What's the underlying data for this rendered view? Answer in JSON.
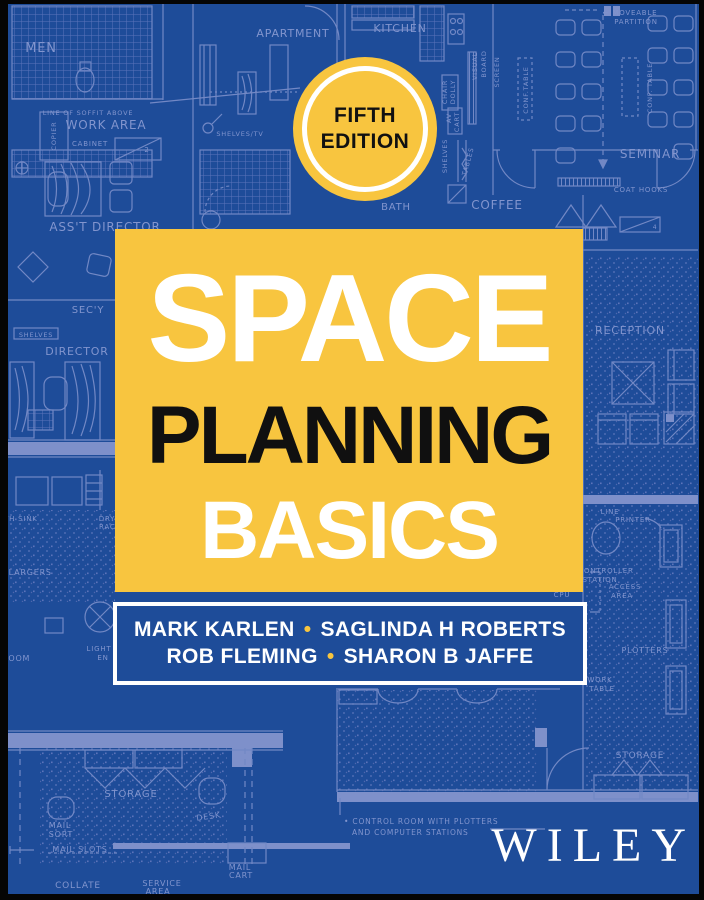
{
  "cover": {
    "edition_badge": {
      "line1": "FIFTH",
      "line2": "EDITION"
    },
    "title": {
      "line1": "SPACE",
      "line2": "PLANNING",
      "line3": "BASICS"
    },
    "authors": {
      "line1_a": "MARK KARLEN",
      "line1_b": "SAGLINDA H ROBERTS",
      "line2_a": "ROB FLEMING",
      "line2_b": "SHARON B JAFFE",
      "separator": "•"
    },
    "publisher": "WILEY",
    "colors": {
      "cover_blue": "#1E4C99",
      "accent_yellow": "#F8C53F",
      "blueprint_line": "#7288C5",
      "blueprint_wall": "#7E90CA",
      "title_white": "#FFFFFF",
      "title_black": "#101010",
      "frame_black": "#050505"
    }
  },
  "blueprint": {
    "labels": [
      {
        "text": "MEN",
        "x": 41,
        "y": 52,
        "size": 13
      },
      {
        "text": "APARTMENT",
        "x": 293,
        "y": 37,
        "size": 11
      },
      {
        "text": "KITCHEN",
        "x": 400,
        "y": 32,
        "size": 11
      },
      {
        "text": "← MOVEABLE",
        "x": 630,
        "y": 15,
        "size": 7
      },
      {
        "text": "PARTITION",
        "x": 636,
        "y": 24,
        "size": 7
      },
      {
        "text": "VISUAL",
        "x": 477,
        "y": 66,
        "size": 6.5,
        "rotate": -90
      },
      {
        "text": "BOARD",
        "x": 486,
        "y": 64,
        "size": 6.5,
        "rotate": -90
      },
      {
        "text": "SCREEN",
        "x": 499,
        "y": 72,
        "size": 6.5,
        "rotate": -90
      },
      {
        "text": "CHAIR",
        "x": 447,
        "y": 92,
        "size": 6.5,
        "rotate": -90
      },
      {
        "text": "DOLLY",
        "x": 455,
        "y": 92,
        "size": 6.5,
        "rotate": -90
      },
      {
        "text": "AV",
        "x": 451,
        "y": 118,
        "size": 6.5,
        "rotate": -90
      },
      {
        "text": "CART",
        "x": 459,
        "y": 122,
        "size": 6.5,
        "rotate": -90
      },
      {
        "text": "SHELVES",
        "x": 447,
        "y": 156,
        "size": 6.5,
        "rotate": -90
      },
      {
        "text": "TABLES",
        "x": 470,
        "y": 162,
        "size": 6.5,
        "rotate": -75
      },
      {
        "text": "SHELVES/TV",
        "x": 240,
        "y": 136,
        "size": 6.5
      },
      {
        "text": "CONF.TABLE",
        "x": 528,
        "y": 90,
        "size": 6.5,
        "rotate": -90
      },
      {
        "text": "CONF. TABLE",
        "x": 652,
        "y": 88,
        "size": 6.5,
        "rotate": -90
      },
      {
        "text": "SEMINAR",
        "x": 650,
        "y": 158,
        "size": 12
      },
      {
        "text": "COAT HOOKS",
        "x": 641,
        "y": 192,
        "size": 7
      },
      {
        "text": "COFFEE",
        "x": 497,
        "y": 209,
        "size": 12
      },
      {
        "text": "BATH",
        "x": 396,
        "y": 210,
        "size": 10
      },
      {
        "text": "LINE OF SOFFIT ABOVE",
        "x": 88,
        "y": 115,
        "size": 6.5
      },
      {
        "text": "WORK AREA",
        "x": 106,
        "y": 129,
        "size": 12
      },
      {
        "text": "CABINET",
        "x": 90,
        "y": 146,
        "size": 7
      },
      {
        "text": "2",
        "x": 147,
        "y": 152,
        "size": 7
      },
      {
        "text": "4",
        "x": 655,
        "y": 229,
        "size": 6
      },
      {
        "text": "COPIER",
        "x": 56,
        "y": 136,
        "size": 6.5,
        "rotate": -90
      },
      {
        "text": "ASS'T DIRECTOR",
        "x": 105,
        "y": 231,
        "size": 12
      },
      {
        "text": "SEC'Y",
        "x": 88,
        "y": 313,
        "size": 10
      },
      {
        "text": "SHELVES",
        "x": 36,
        "y": 337,
        "size": 6.5
      },
      {
        "text": "DIRECTOR",
        "x": 77,
        "y": 355,
        "size": 11
      },
      {
        "text": "TH SINK",
        "x": 4,
        "y": 521,
        "size": 7,
        "anchor": "start"
      },
      {
        "text": "DRY",
        "x": 107,
        "y": 521,
        "size": 7
      },
      {
        "text": "RACK",
        "x": 110,
        "y": 529,
        "size": 7
      },
      {
        "text": "ENLARGERS",
        "x": -4,
        "y": 575,
        "size": 8,
        "anchor": "start"
      },
      {
        "text": "LIGHT",
        "x": 99,
        "y": 651,
        "size": 7
      },
      {
        "text": "EN",
        "x": 103,
        "y": 660,
        "size": 7
      },
      {
        "text": "ROOM",
        "x": 2,
        "y": 661,
        "size": 8,
        "anchor": "start"
      },
      {
        "text": "RECEPTION",
        "x": 630,
        "y": 334,
        "size": 11
      },
      {
        "text": "LINE",
        "x": 610,
        "y": 514,
        "size": 7
      },
      {
        "text": "PRINTER",
        "x": 633,
        "y": 522,
        "size": 7
      },
      {
        "text": "CONTROLLER",
        "x": 606,
        "y": 573,
        "size": 7
      },
      {
        "text": "STATION",
        "x": 600,
        "y": 582,
        "size": 7
      },
      {
        "text": "ACCESS",
        "x": 625,
        "y": 589,
        "size": 7
      },
      {
        "text": "AREA",
        "x": 622,
        "y": 598,
        "size": 7
      },
      {
        "text": "CPU",
        "x": 562,
        "y": 597,
        "size": 7
      },
      {
        "text": "PLOTTERS",
        "x": 645,
        "y": 653,
        "size": 8
      },
      {
        "text": "WORK",
        "x": 600,
        "y": 682,
        "size": 7
      },
      {
        "text": "TABLE",
        "x": 602,
        "y": 691,
        "size": 7
      },
      {
        "text": "STORAGE",
        "x": 640,
        "y": 758,
        "size": 9
      },
      {
        "text": "STORAGE",
        "x": 131,
        "y": 797,
        "size": 10
      },
      {
        "text": "DESK",
        "x": 209,
        "y": 819,
        "size": 8,
        "rotate": -8
      },
      {
        "text": "MAIL",
        "x": 60,
        "y": 828,
        "size": 8
      },
      {
        "text": "SORT",
        "x": 61,
        "y": 837,
        "size": 8
      },
      {
        "text": "MAIL SLOTS",
        "x": 80,
        "y": 852,
        "size": 8
      },
      {
        "text": "MAIL",
        "x": 240,
        "y": 870,
        "size": 8
      },
      {
        "text": "CART",
        "x": 241,
        "y": 878,
        "size": 8
      },
      {
        "text": "COLLATE",
        "x": 78,
        "y": 888,
        "size": 9
      },
      {
        "text": "SERVICE",
        "x": 162,
        "y": 886,
        "size": 8
      },
      {
        "text": "AREA",
        "x": 158,
        "y": 894,
        "size": 8
      },
      {
        "text": "• CONTROL ROOM WITH PLOTTERS",
        "x": 344,
        "y": 824,
        "size": 7.5,
        "anchor": "start"
      },
      {
        "text": "AND COMPUTER STATIONS",
        "x": 352,
        "y": 835,
        "size": 7.5,
        "anchor": "start"
      }
    ]
  }
}
